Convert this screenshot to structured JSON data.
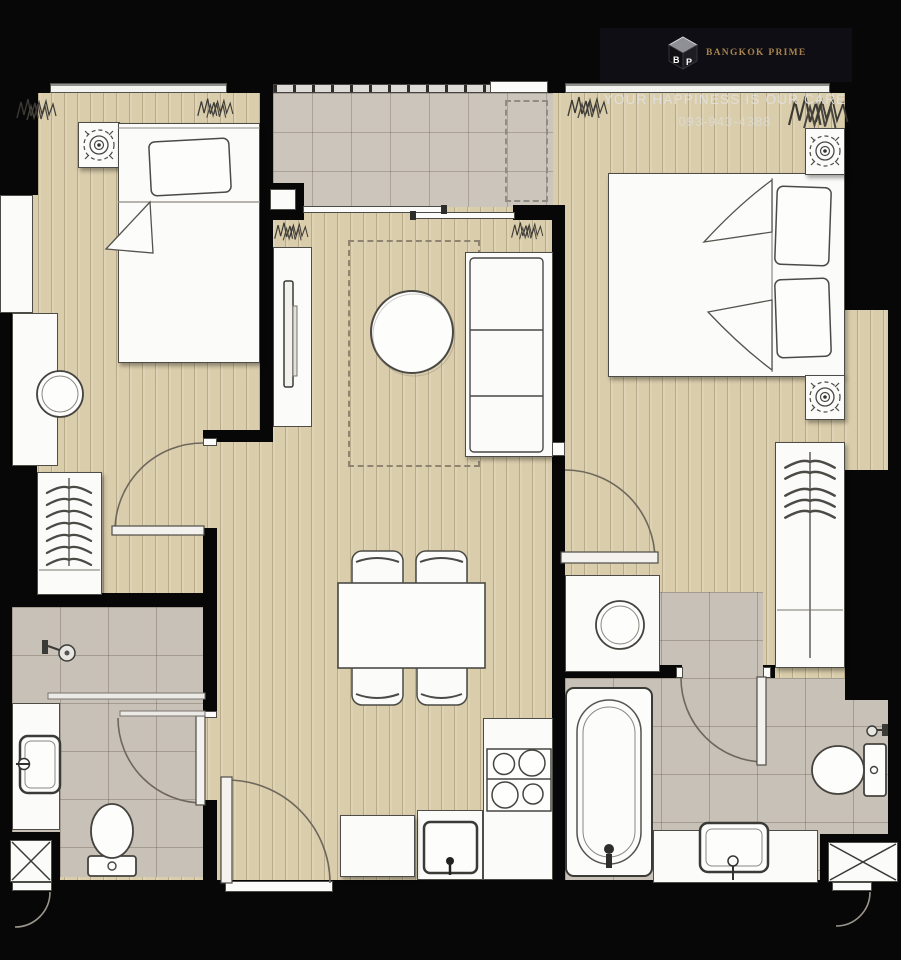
{
  "banner": {
    "brand": "BANGKOK PRIME",
    "tagline": "YOUR HAPPINESS IS OUR CARE",
    "phone": "093-943-4388",
    "logo_letters": {
      "left": "B",
      "right": "P"
    }
  },
  "palette": {
    "background": "#000000",
    "wood_floor": "#dacdab",
    "bathroom_tile": "#c8c1b7",
    "balcony_tile": "#ccc5bc",
    "wall": "#070707",
    "furniture": "#fbfbf9",
    "outline": "#4e4c47",
    "banner_bg": "#0e0e14",
    "brand_gold": "#a8834c",
    "text_light": "#e2e1dd"
  },
  "icons": [
    "plant-icon",
    "ceiling-lamp-icon",
    "hanger-icon",
    "stove-burners-icon",
    "kitchen-sink-icon",
    "toilet-icon",
    "bathtub-icon",
    "shower-head-icon",
    "washbasin-icon",
    "door-swing-icon",
    "window-icon",
    "balcony-railing-icon",
    "shaft-cross-icon",
    "cube-logo-icon",
    "rug-outline",
    "ac-unit-outline"
  ]
}
